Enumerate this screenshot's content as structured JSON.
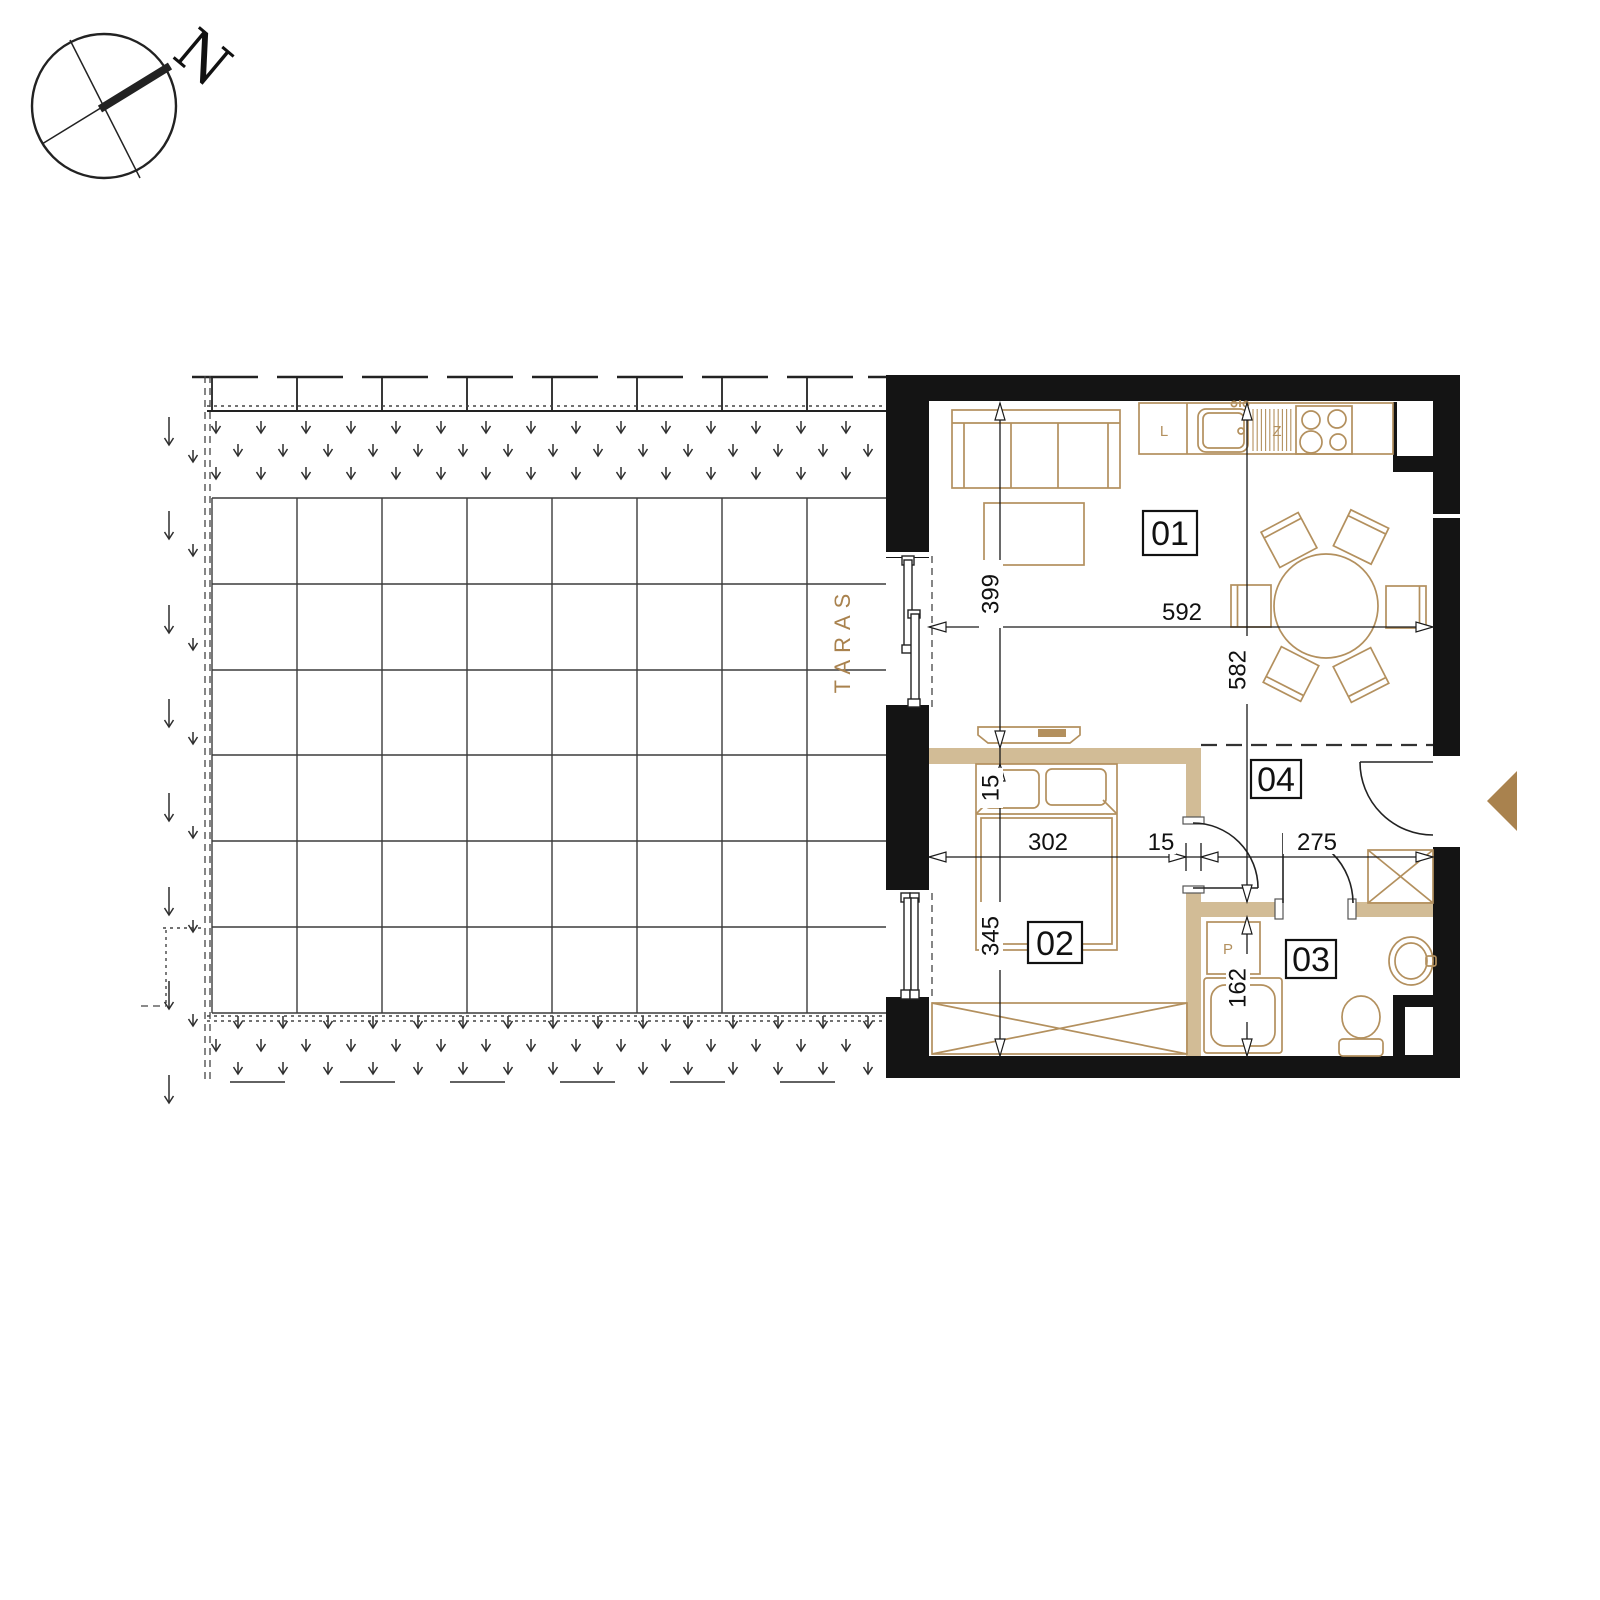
{
  "plan": {
    "compass": {
      "north": "N"
    },
    "terrace": {
      "label": "TARAS"
    },
    "rooms": {
      "living": "01",
      "bedroom": "02",
      "bathroom": "03",
      "hall": "04"
    },
    "kitchen": {
      "fridge_label": "L",
      "sink_label": "Z"
    },
    "laundry": {
      "washer_label": "P"
    },
    "dimensions": {
      "living_width": "592",
      "living_depth": "399",
      "apartment_depth": "582",
      "bedroom_width": "302",
      "partition_thickness": "15",
      "hall_width": "275",
      "bedroom_depth": "345",
      "bath_depth": "162"
    },
    "colors": {
      "wall": "#141414",
      "partition": "#d2bc96",
      "furniture": "#b3905e",
      "accent": "#a9824e"
    }
  }
}
